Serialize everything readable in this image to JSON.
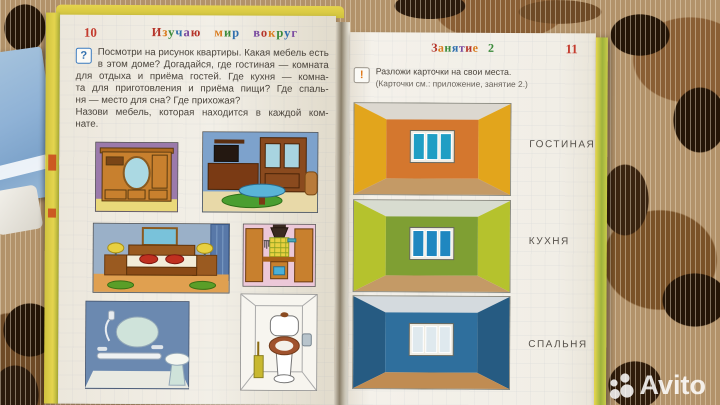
{
  "left_page": {
    "page_number": "10",
    "title": "Изучаю мир вокруг",
    "icon_glyph": "?",
    "text_lines": [
      "Посмотри на рисунок квартиры. Какая мебель есть",
      "в этом доме? Догадайся, где гостиная — комната",
      "для отдыха и приёма гостей. Где кухня — комна-",
      "та для приготовления и приёма пищи? Где спаль-",
      "ня — место для сна? Где прихожая?",
      "Назови мебель, которая находится в каждой ком-",
      "нате."
    ],
    "illustrations": [
      {
        "name": "hallway",
        "wall": "#9b7aab",
        "floor": "#ead97a",
        "furniture": "#c8802e"
      },
      {
        "name": "living-room",
        "wall": "#7da2cc",
        "floor": "#e8d9a8",
        "furniture": "#8a4a1e"
      },
      {
        "name": "bedroom",
        "wall": "#9ab0c8",
        "floor": "#e0a050",
        "furniture": "#9a5a20"
      },
      {
        "name": "kitchen",
        "wall": "#ecc8d8",
        "counter": "#a86018",
        "furniture": "#c8802e"
      },
      {
        "name": "bathroom",
        "wall": "#6b89b0",
        "floor": "#e9eae2",
        "fixture": "#cfe3da"
      },
      {
        "name": "toilet",
        "wall": "#f7f5ef",
        "seat": "#a0522d",
        "brush": "#c8b830"
      }
    ]
  },
  "right_page": {
    "page_number": "11",
    "title": "Занятие 2",
    "icon_glyph": "!",
    "text_lines": [
      "Разложи карточки на свои места.",
      "(Карточки см.: приложение, занятие 2.)"
    ],
    "rooms": [
      {
        "label": "ГОСТИНАЯ",
        "back_wall": "#d4772e",
        "side_wall": "#e2a51c",
        "ceiling": "#dcd8d0",
        "floor": "#c49a66",
        "window_pane": "#1f9ec4"
      },
      {
        "label": "КУХНЯ",
        "back_wall": "#7f9f33",
        "side_wall": "#b5c22d",
        "ceiling": "#d8dcd0",
        "floor": "#c49a66",
        "window_pane": "#1f87c0"
      },
      {
        "label": "СПАЛЬНЯ",
        "back_wall": "#2f6f9d",
        "side_wall": "#265b82",
        "ceiling": "#d4dade",
        "floor": "#c08c52",
        "window_pane": "#dfe9ee"
      }
    ]
  },
  "watermark": {
    "brand": "Avito"
  },
  "theme": {
    "page_color": "#f1eee6",
    "accent_red": "#c43b2e",
    "title_letter_colors": [
      "#b5342a",
      "#d97b1e",
      "#3a8a3a",
      "#2f6fae",
      "#7a4aa0"
    ],
    "carpet_base": "#b2926a",
    "carpet_dark": "#241507"
  }
}
